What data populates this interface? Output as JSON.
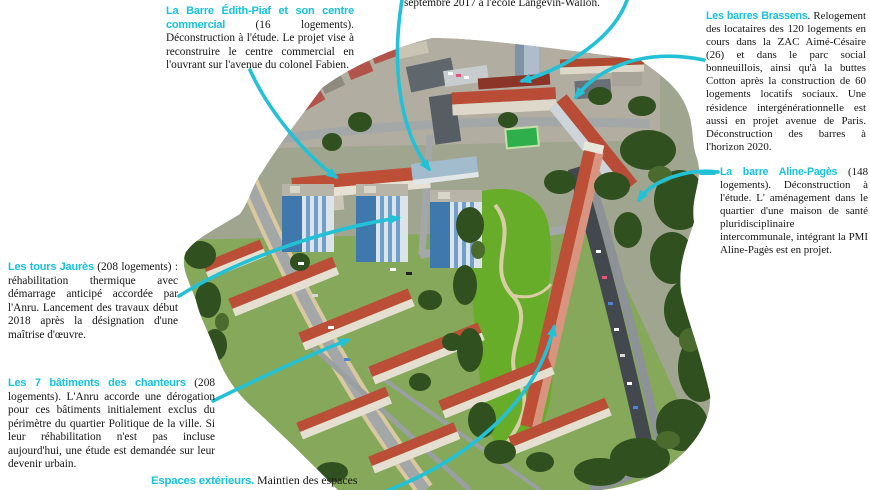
{
  "title": "Annotated aerial view of an urban renewal district",
  "colors": {
    "accent_cyan": "#1fc2d8",
    "body_text": "#141414",
    "roof_red": "#bb4e36",
    "park_green": "#67ad29",
    "tree_green": "#31501f",
    "tower_blue": "#4f8fc4",
    "background": "#ffffff"
  },
  "annotations": {
    "edith_piaf": {
      "heading": "La Barre Édith-Piaf et son centre commercial",
      "body": " (16 logements). Déconstruction à l'étude. Le projet vise à reconstruire le centre commercial en l'ouvrant sur l'avenue du colonel Fabien."
    },
    "ecole": {
      "body": "septembre 2017 à l'école Langevin-Wallon."
    },
    "brassens": {
      "heading": "Les barres Brassens",
      "body": ". Relogement des locataires des 120 logements en cours dans la ZAC Aimé-Césaire (26) et dans le parc social bonneuillois, ainsi qu'à la buttes Cotton après la construction de 60 logements locatifs sociaux. Une résidence intergénérationnelle est aussi en projet avenue de Paris. Déconstruction des barres à l'horizon 2020."
    },
    "aline_pages": {
      "heading": "La barre Aline-Pagès",
      "body": " (148 logements). Déconstruction à l'étude. L' aménagement dans le quartier d'une maison de santé pluridisciplinaire intercommunale, intégrant la PMI Aline-Pagès est en projet."
    },
    "jaures": {
      "heading": "Les tours Jaurès",
      "body": " (208 logements) : réhabilitation thermique avec démarrage anticipé accordée par l'Anru. Lancement des travaux début 2018 après la désignation d'une maîtrise d'œuvre."
    },
    "chanteurs": {
      "heading": "Les 7 bâtiments des chanteurs",
      "body": " (208 logements). L'Anru accorde une dérogation pour ces bâtiments initialement exclus du périmètre du quartier Politique de la ville. Si leur réhabilitation n'est pas incluse aujourd'hui, une étude est demandée sur leur devenir urbain."
    },
    "espaces": {
      "heading": "Espaces extérieurs.",
      "body": " Maintien des espaces"
    }
  }
}
